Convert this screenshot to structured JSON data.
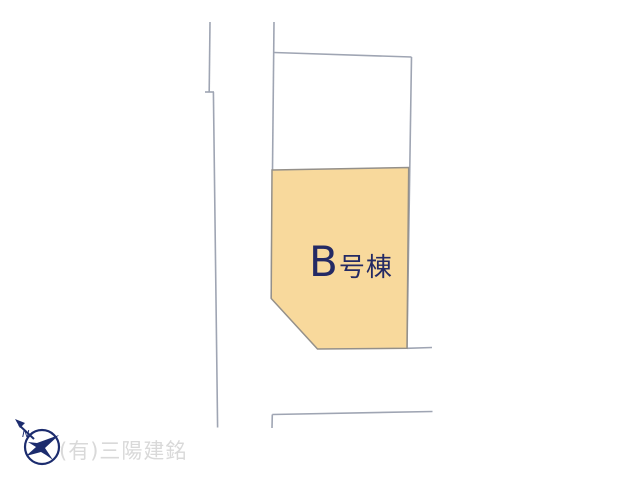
{
  "plan": {
    "parcel": {
      "name": "B号棟",
      "name_letter": "B",
      "name_suffix": "号棟",
      "fill": "#f8d99c",
      "border_color": "#94908a",
      "label_color": "#242a64"
    },
    "road_line_color": "#9fa5b3",
    "background": "#ffffff"
  },
  "compass": {
    "letter": "N",
    "color": "#1c2c6e"
  },
  "watermark": {
    "text": "(有)三陽建銘",
    "color": "#d9d9d9"
  }
}
